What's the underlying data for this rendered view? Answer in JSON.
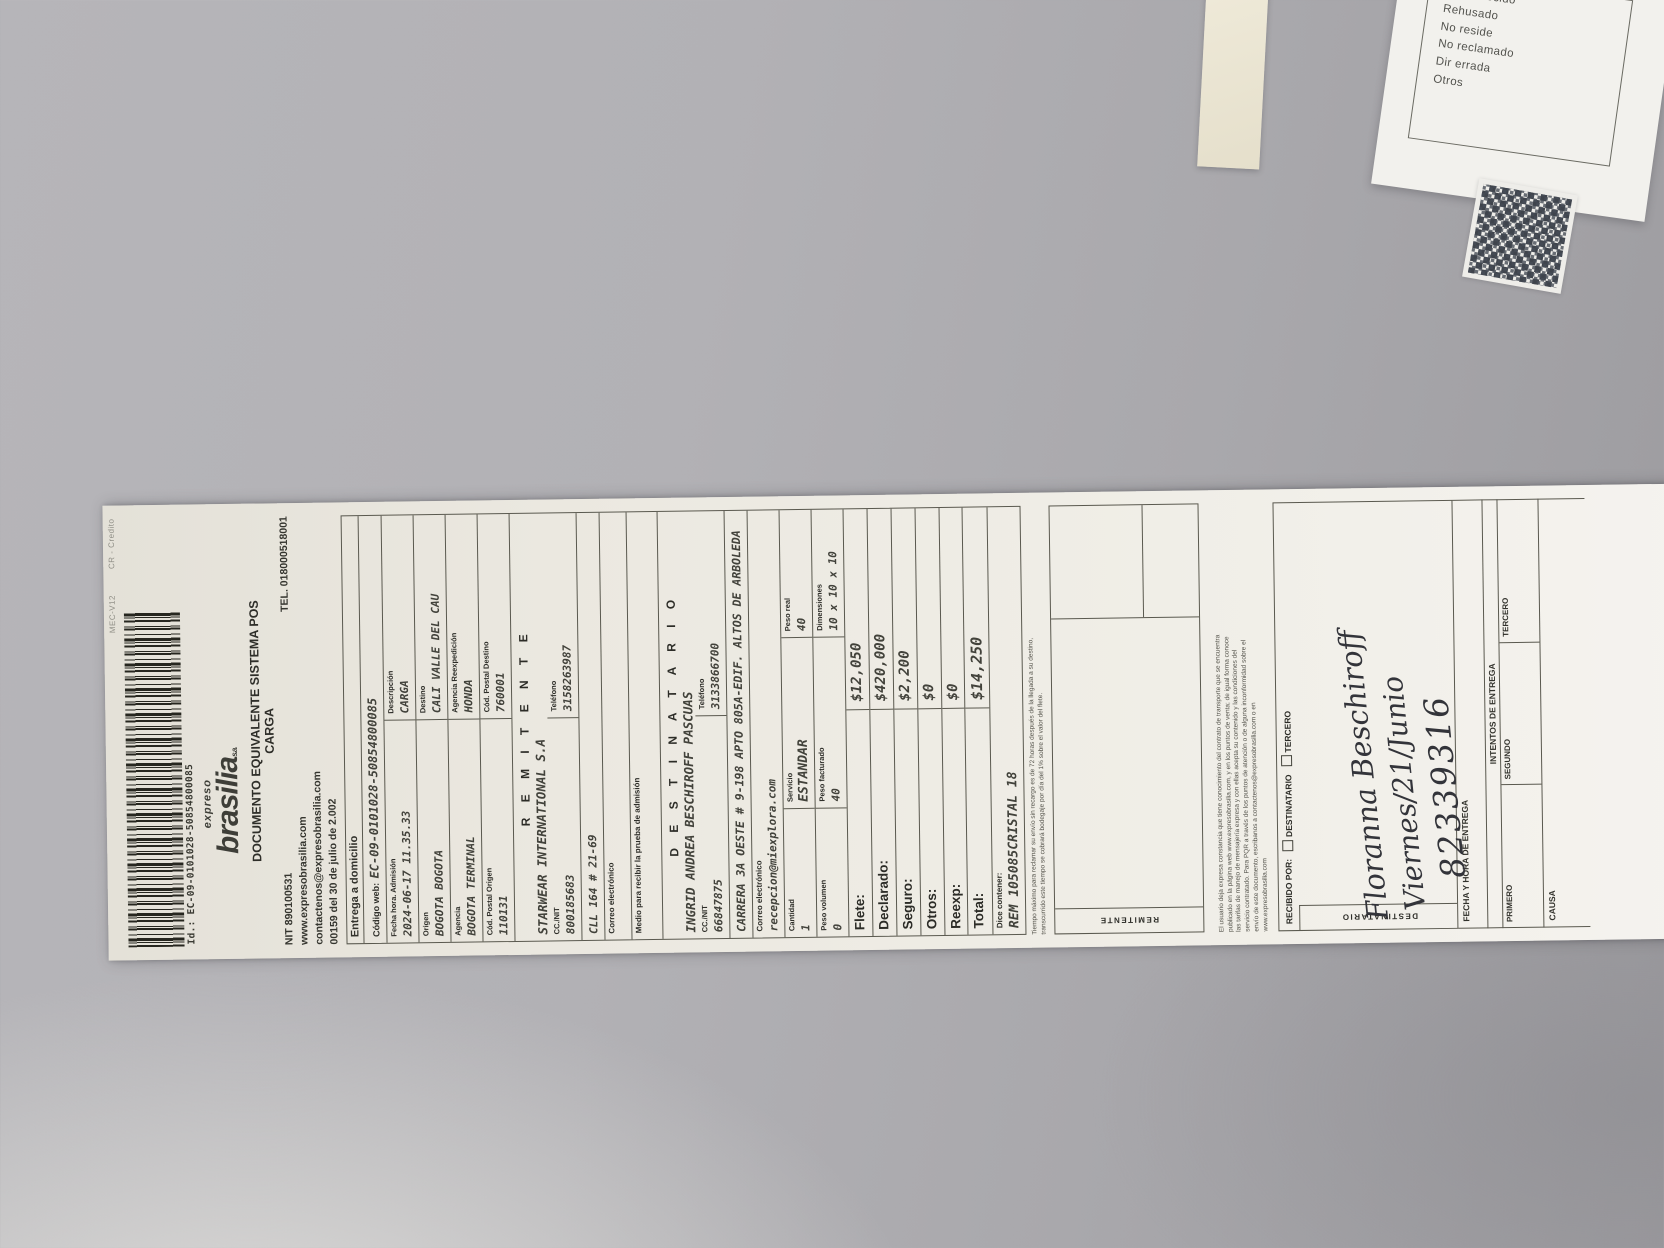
{
  "colors": {
    "wall": "#b1b0b4",
    "paper": "#efede6",
    "ink": "#3c3c36"
  },
  "receipt": {
    "payment_type": "CR - Credito",
    "terminal": "MEC-V12",
    "barcode_id": "Id.: EC-09-0101028-50854800085",
    "logo": {
      "top": "expreso",
      "name": "brasilia",
      "suffix": "s.a."
    },
    "title_line1": "DOCUMENTO EQUIVALENTE SISTEMA POS",
    "title_line2": "CARGA",
    "nit": "NIT 890100531",
    "tel": "TEL. 018000518001",
    "website": "www.expresobrasilia.com",
    "contact_email": "contactenos@expresobrasilia.com",
    "resolution": "00159 del 30 de julio de 2.002",
    "delivery_type": "Entrega a domicilio",
    "codigo_web": {
      "label": "Código web:",
      "value": "EC-09-0101028-50854800085"
    },
    "admision": {
      "label": "Fecha hora. Admisión",
      "value": "2024-06-17 11.35.33"
    },
    "descripcion": {
      "label": "Descripción",
      "value": "CARGA"
    },
    "origen": {
      "label": "Origen",
      "value": "BOGOTA BOGOTA"
    },
    "destino": {
      "label": "Destino",
      "value": "CALI VALLE DEL CAU"
    },
    "agencia": {
      "label": "Agencia",
      "value": "BOGOTA TERMINAL"
    },
    "agencia_reexpedicion": {
      "label": "Agencia Reexpedición",
      "value": "HONDA"
    },
    "cp_origen": {
      "label": "Cód. Postal Origen",
      "value": "110131"
    },
    "cp_destino": {
      "label": "Cód. Postal Destino",
      "value": "760001"
    },
    "remitente": {
      "title": "R E M I T E N T E",
      "nombre": "STARWEAR INTERNATIONAL S.A",
      "nit_label": "CC./NIT",
      "nit_value": "800185683",
      "tel_label": "Teléfono",
      "tel_value": "3158263987",
      "direccion": "CLL 164 # 21-69",
      "correo_label": "Correo electrónico"
    },
    "prueba_admision_label": "Medio para recibir la prueba de admisión",
    "destinatario": {
      "title": "D E S T I N A T A R I O",
      "nombre": "INGRID ANDREA BESCHIROFF PASCUAS",
      "nit_label": "CC./NIT",
      "nit_value": "66847875",
      "tel_label": "Teléfono",
      "tel_value": "3133866700",
      "direccion": "CARRERA 3A OESTE # 9-198 APTO 805A-EDIF. ALTOS DE ARBOLEDA",
      "correo_label": "Correo electrónico",
      "correo_value": "recepcion@miexplora.com"
    },
    "envio": {
      "cantidad_label": "Cantidad",
      "cantidad": "1",
      "servicio_label": "Servicio",
      "servicio": "ESTANDAR",
      "peso_real_label": "Peso real",
      "peso_real": "40",
      "peso_volumen_label": "Peso volumen",
      "peso_volumen": "0",
      "peso_facturado_label": "Peso facturado",
      "peso_facturado": "40",
      "dimensiones_label": "Dimensiones",
      "dimensiones": "10 x 10 x 10"
    },
    "valores": [
      {
        "label": "Flete:",
        "value": "$12,050"
      },
      {
        "label": "Declarado:",
        "value": "$420,000"
      },
      {
        "label": "Seguro:",
        "value": "$2,200"
      },
      {
        "label": "Otros:",
        "value": "$0"
      },
      {
        "label": "Reexp:",
        "value": "$0"
      },
      {
        "label": "Total:",
        "value": "$14,250"
      }
    ],
    "dice_contener": {
      "label": "Dice contener:",
      "value": "REM 105085CRISTAL 18"
    },
    "fine_print_1": [
      "Tiempo máximo para reclamar su envío sin recargo es de 72 horas después de la llegada a su destino,",
      "transcurrido este tiempo se cobrará bodegaje por día del 1% sobre el valor del flete."
    ],
    "fine_print_2": [
      "El usuario deja expresa constancia que tiene conocimiento del contrato de transporte que se encuentra",
      "publicado en la página web www.expresobrasilia.com, y en los puntos de venta; de igual forma conoce",
      "las tarifas de manejo de mensajería expresa y con ellas acepta su contenido y las condiciones del",
      "servicio contratado. Para PQR a través de los puntos de atención o de alguna inconformidad sobre el",
      "envío de este documento, escribanos a contactenos@expresobrasilia.com o en",
      "www.expresobrasilia.com"
    ],
    "firmas": {
      "remitente_label": "REMITENTE",
      "recibido_por": "RECIBIDO POR:",
      "chk_destinatario": "DESTINATARIO",
      "chk_tercero": "TERCERO",
      "destinatario_label": "DESTINATARIO",
      "fecha_entrega": "FECHA Y HORA DE ENTREGA",
      "intentos": "INTENTOS DE ENTREGA",
      "primero": "PRIMERO",
      "segundo": "SEGUNDO",
      "tercero": "TERCERO",
      "causa": "CAUSA"
    },
    "handwriting": {
      "line1": "Floranna Beschiroff",
      "line2": "Viernes/21/Junio",
      "line3": "82339316"
    }
  },
  "return_label": {
    "items": [
      "Desconocido",
      "Rehusado",
      "No reside",
      "No reclamado",
      "Dir errada",
      "Otros"
    ]
  }
}
